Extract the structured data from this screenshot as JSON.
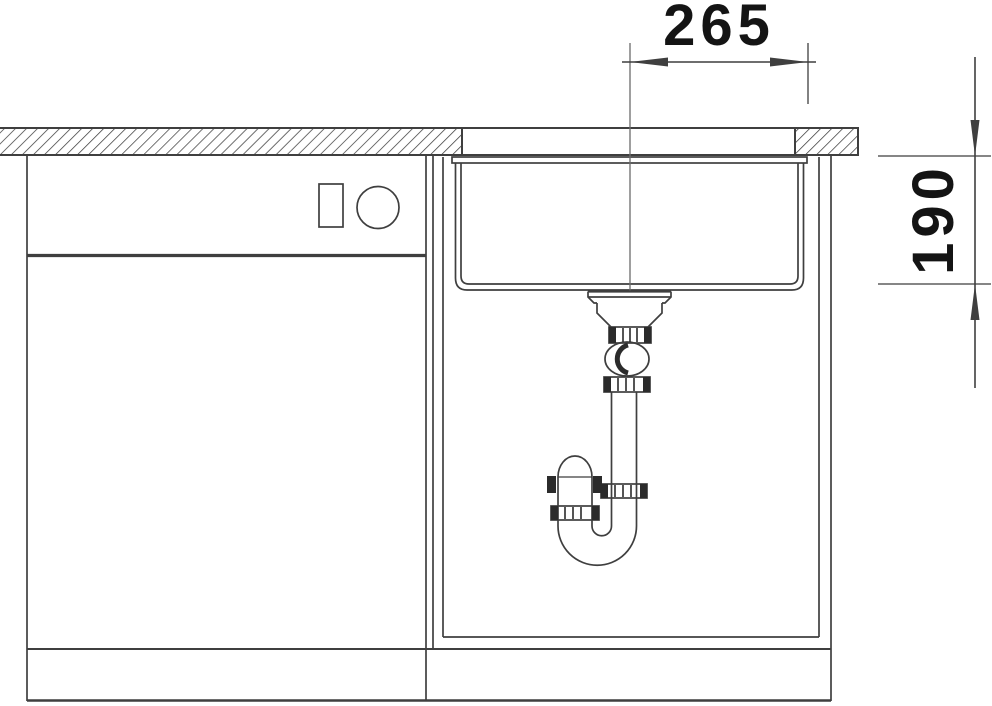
{
  "diagram": {
    "dimension_labels": {
      "horizontal": "265",
      "vertical": "190"
    }
  },
  "colors": {
    "background": "#ffffff",
    "line": "#3f3f3f",
    "centerline": "#6b6b6b",
    "dimension_text": "#141414",
    "fitting_dark": "#2b2b2b"
  }
}
